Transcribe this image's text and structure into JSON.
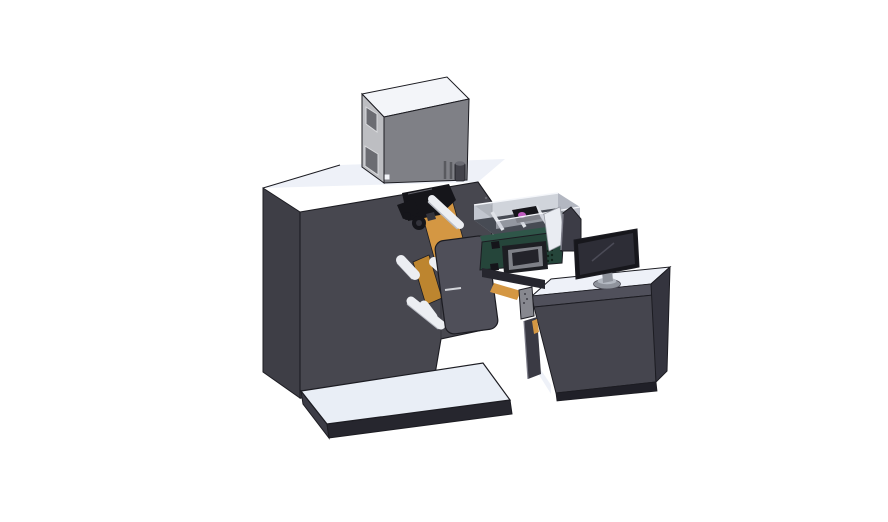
{
  "colors": {
    "background": "#ffffff",
    "outline": "#1c1c22",
    "seam": "#2e2e38",
    "white_top": "#eef1f8",
    "platform_top": "#e9eef6",
    "platform_side": "#3c3c46",
    "platform_edge": "#26262e",
    "tower_front": "#47474f",
    "tower_side": "#3e3e46",
    "box_top": "#f3f5f9",
    "box_side": "#bdbec2",
    "box_front": "#7f8086",
    "box_window": "#6b6c72",
    "window_frame": "#d9dadd",
    "box_vent": "#595a5f",
    "cylinder": "#43434b",
    "cylinder_top": "#6a6b73",
    "tray_glass": "#c6cad3",
    "tray_glass_dark": "#a8adb8",
    "tray_floor": "#474b54",
    "tray_rib": "#dfe2e8",
    "mech_black": "#15151a",
    "mech_detail": "#34343c",
    "mech_highlight": "#62626a",
    "magenta": "#c05cc0",
    "orange": "#d49743",
    "orange_deep": "#bd852f",
    "roller_white": "#eceef2",
    "roller_shade": "#b9bcc4",
    "cover": "#4f4f59",
    "cover_label": "#d4d6db",
    "green_top": "#2f5649",
    "green_front": "#25453a",
    "bezel": "#1d1e23",
    "bezel_frame": "#7e8087",
    "bezel_screen": "#23232a",
    "green_vent": "#102119",
    "guide": "#e9ecf2",
    "guide_edge": "#9a9da5",
    "panel": "#3c3c46",
    "panel_hl": "#7e7e8a",
    "desk_band": "#50505b",
    "desk_front": "#45454e",
    "desk_right": "#34343e",
    "desk_base": "#202028",
    "desk_leg": "#3a3a44",
    "bar": "#26262e",
    "bracket": "#87888f",
    "bracket_dot": "#3f3f47",
    "monitor_bezel": "#17171c",
    "monitor_screen": "#2d2d36",
    "monitor_refl": "#4b4b57",
    "stand": "#8f939c",
    "stand_light": "#b3b8c1",
    "stand_edge": "#4e4e58",
    "screw": "#6a6a72"
  },
  "scene": {
    "subject": "Isometric 3D CAD render of a label printing and rewinding machine with an operator desk",
    "objects": [
      "main-machine-tower",
      "control-cabinet",
      "base-platform",
      "print-head-mechanism",
      "unwind-rollers",
      "media-cover-plate",
      "thermal-printer-unit",
      "feed-tray",
      "paper-guide",
      "divider-panel",
      "operator-desk",
      "support-bracket",
      "desktop-monitor"
    ]
  }
}
